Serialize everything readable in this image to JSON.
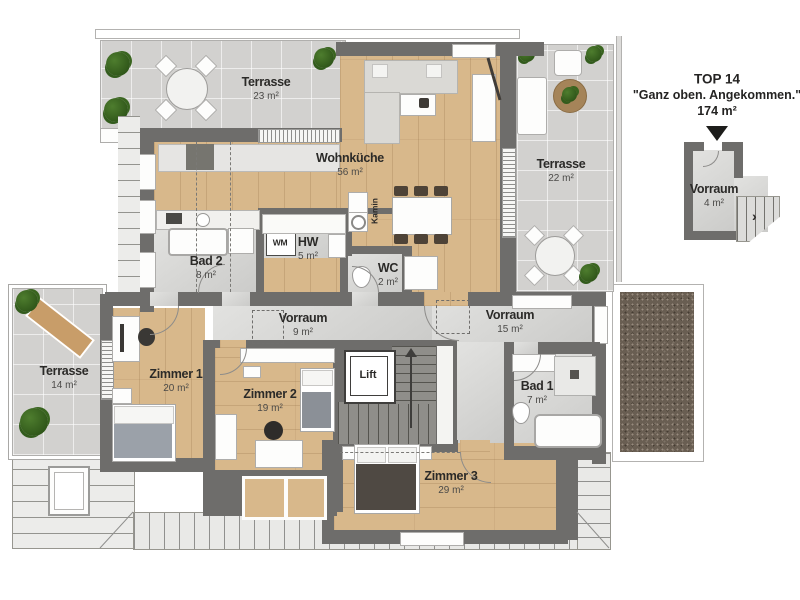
{
  "header": {
    "unit": "TOP 14",
    "slogan": "\"Ganz oben. Angekommen.\"",
    "total_area": "174 m²"
  },
  "inset": {
    "name": "Vorraum",
    "area": "4 m²",
    "stair_arrow": "›"
  },
  "rooms": {
    "terrasse_nw": {
      "name": "Terrasse",
      "area": "23 m²"
    },
    "wohnkueche": {
      "name": "Wohnküche",
      "area": "56 m²"
    },
    "terrasse_e": {
      "name": "Terrasse",
      "area": "22 m²"
    },
    "bad2": {
      "name": "Bad 2",
      "area": "8 m²"
    },
    "hw": {
      "name": "HW",
      "area": "5 m²"
    },
    "wm": {
      "name": "WM"
    },
    "wc": {
      "name": "WC",
      "area": "2 m²"
    },
    "vorraum_w": {
      "name": "Vorraum",
      "area": "9 m²"
    },
    "vorraum_e": {
      "name": "Vorraum",
      "area": "15 m²"
    },
    "terrasse_w": {
      "name": "Terrasse",
      "area": "14 m²"
    },
    "zimmer1": {
      "name": "Zimmer 1",
      "area": "20 m²"
    },
    "zimmer2": {
      "name": "Zimmer 2",
      "area": "19 m²"
    },
    "zimmer3": {
      "name": "Zimmer 3",
      "area": "29 m²"
    },
    "bad1": {
      "name": "Bad 1",
      "area": "7 m²"
    },
    "lift": {
      "name": "Lift"
    },
    "kamin": {
      "name": "Kamin"
    }
  },
  "colors": {
    "wall": "#6e6d6b",
    "wood": "#d8b88b",
    "tile": "#d2d1cf",
    "roof": "#ebebe9",
    "gravel": "#695e52",
    "plant": "#39641f"
  }
}
